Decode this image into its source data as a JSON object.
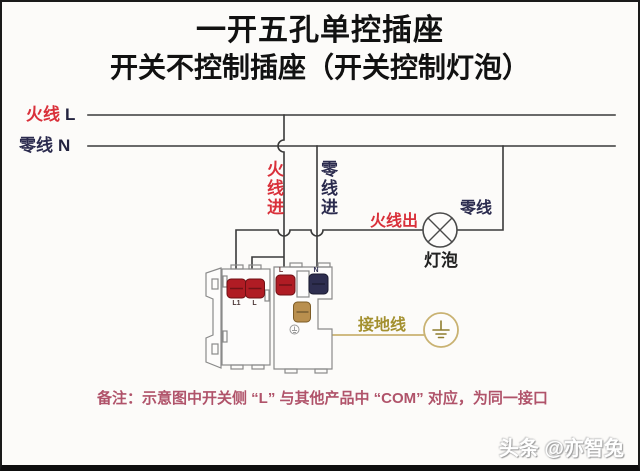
{
  "title": {
    "line1": "一开五孔单控插座",
    "line2": "开关不控制插座（开关控制灯泡）"
  },
  "feeders": {
    "live_name": "火线",
    "live_letter": "L",
    "neutral_name": "零线",
    "neutral_letter": "N"
  },
  "wire_labels": {
    "live_in": "火线进",
    "neutral_in": "零线进",
    "live_out": "火线出",
    "neutral_to_bulb": "零线",
    "bulb": "灯泡",
    "earth": "接地线"
  },
  "device": {
    "switch_terminals": [
      "L1",
      "L"
    ],
    "socket_live": "L",
    "socket_neutral": "N"
  },
  "icons": {
    "bulb": "bulb-icon (circle with X lamp symbol)",
    "earth": "earth-ground-icon (circle with ground bars)",
    "earth_mark_on_device": "earth-mark-icon"
  },
  "note": "备注：示意图中开关侧 “L” 与其他产品中 “COM” 对应，为同一接口",
  "watermark": "头条 @亦智兔",
  "colors": {
    "red": "#d9303a",
    "navy": "#2b2b4e",
    "wire": "#3a3a3a",
    "earth-line": "#c9b272",
    "earth-text": "#a3902f",
    "note": "#b0536a",
    "term-red": "#b01c24",
    "term-navy": "#2e2e50",
    "term-brass": "#b98f4e"
  }
}
